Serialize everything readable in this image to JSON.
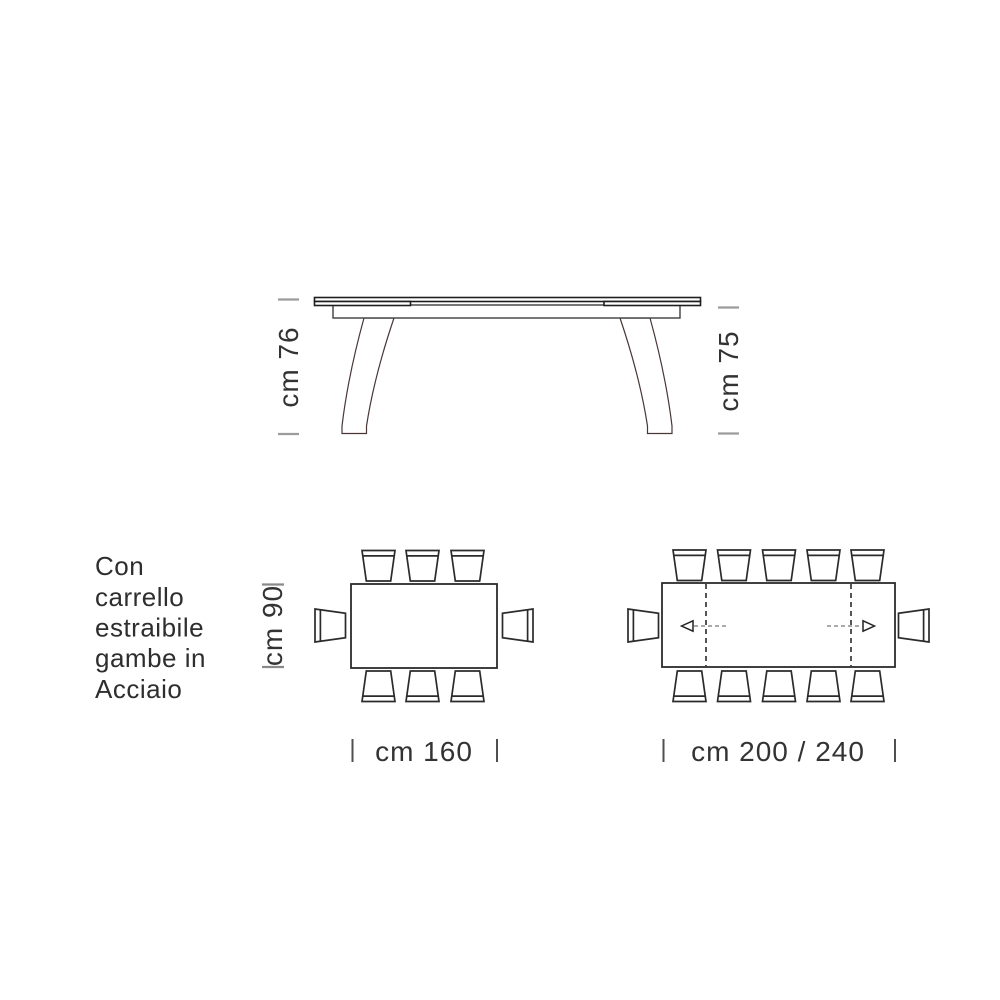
{
  "description": {
    "lines": [
      "Con",
      "carrello",
      "estraibile",
      "gambe in",
      "Acciaio"
    ],
    "full_text": "Con carrello estraibile gambe in Acciaio"
  },
  "side_view": {
    "height_left": "cm 76",
    "height_right": "cm 75"
  },
  "plans": {
    "small": {
      "width_label": "cm 160",
      "depth_label": "cm 90",
      "chairs": {
        "top": 3,
        "bottom": 3,
        "left": 1,
        "right": 1
      },
      "seats_total": 8
    },
    "large": {
      "width_label": "cm 200 / 240",
      "chairs": {
        "top": 5,
        "bottom": 5,
        "left": 1,
        "right": 1
      },
      "seats_total": 12
    }
  },
  "colors": {
    "background": "#ffffff",
    "line": "#2b2b2b",
    "leg_line": "#4a3636",
    "tick_gray": "#9c9c9c",
    "text": "#333333"
  }
}
